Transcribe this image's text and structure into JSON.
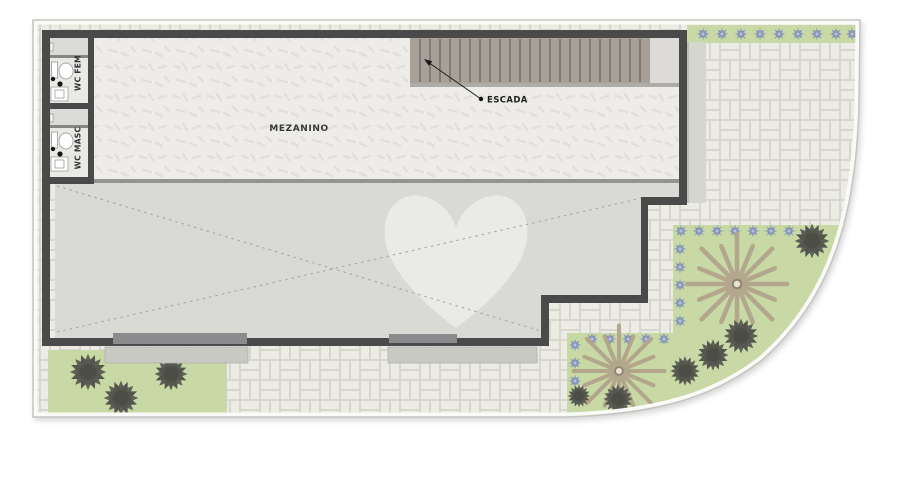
{
  "plan": {
    "labels": {
      "mezzanine": "MEZANINO",
      "stairs_callout": "ESCADA",
      "wc_female": "WC FEM",
      "wc_male": "WC MASC"
    },
    "colors": {
      "wall": "#4a4a4a",
      "mezzanine_floor": "#edece9",
      "lower_floor": "#d9d9d6",
      "paving_brick": "#ecece5",
      "paving_joint": "#d7d7cf",
      "grass": "#c9d9a6",
      "shrub": "#5f6158",
      "palm_frond": "#b2a78c",
      "flower_plant": "#7282ae",
      "stair_fill": "#a7a098",
      "boundary_line": "#c5c5bf",
      "threshold": "#c9c9c4",
      "door_slab": "#8b8b8e",
      "watermark": "#ffffff"
    }
  }
}
